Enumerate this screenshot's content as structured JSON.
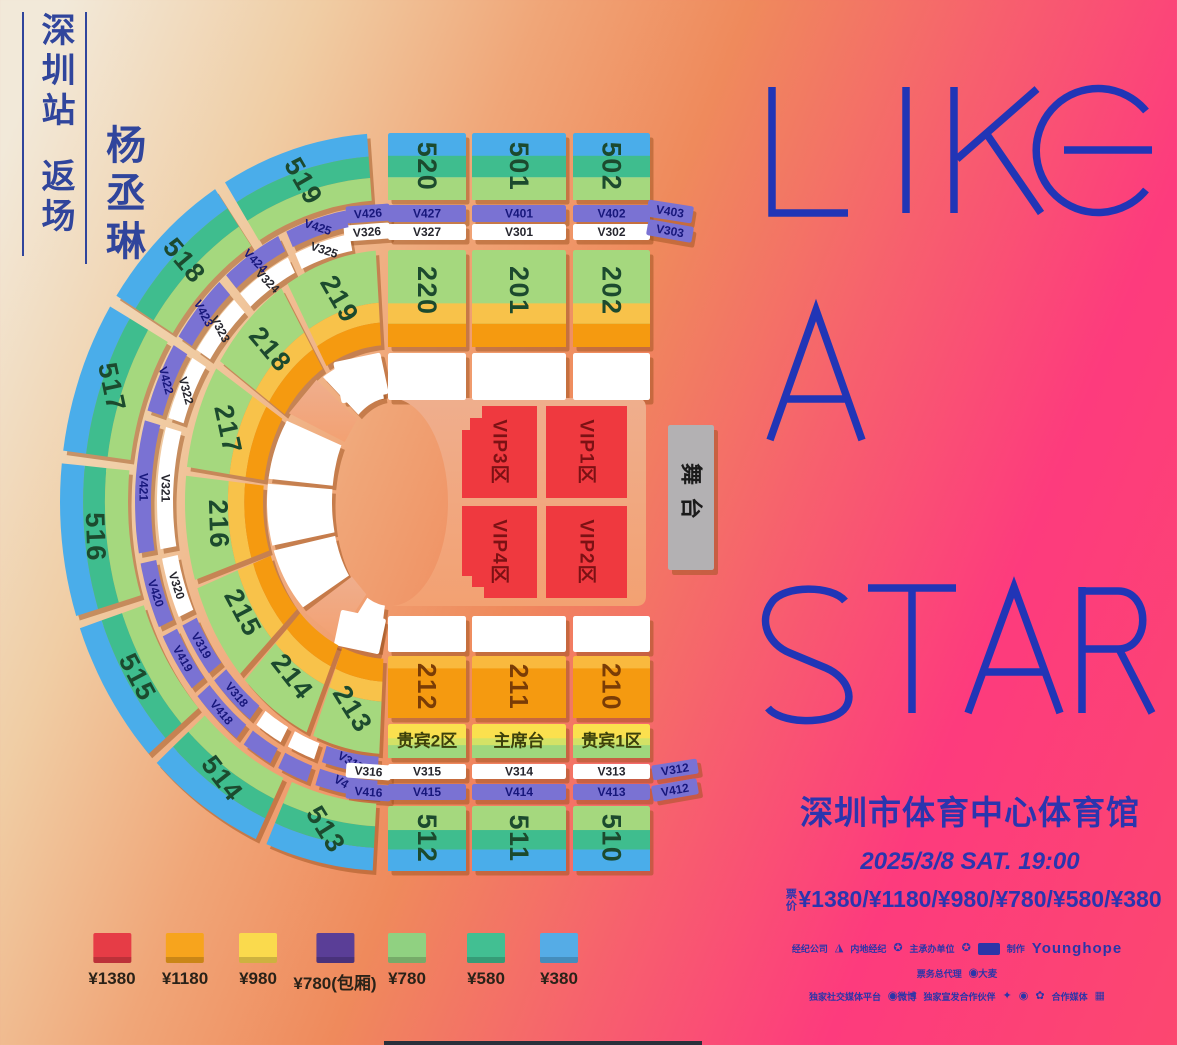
{
  "poster": {
    "header": {
      "station": "深圳站",
      "show_type": "返场",
      "artist": "杨丞琳"
    },
    "title_lines": [
      "LIKE",
      "A",
      "STAR"
    ],
    "title_color": "#2135b6",
    "venue": "深圳市体育中心体育馆",
    "datetime": "2025/3/8 SAT. 19:00",
    "price_label": "票价",
    "price_line": "¥1380/¥1180/¥980/¥780/¥580/¥380"
  },
  "map": {
    "stage_label": "舞台",
    "outer_top": [
      "520",
      "501",
      "502"
    ],
    "outer_arc": [
      "519",
      "518",
      "517",
      "516",
      "515",
      "514",
      "513"
    ],
    "outer_bottom": [
      "512",
      "511",
      "510"
    ],
    "inner_top": [
      "220",
      "201",
      "202"
    ],
    "inner_arc": [
      "219",
      "218",
      "217",
      "216",
      "215",
      "214",
      "213"
    ],
    "inner_bottom": [
      "212",
      "211",
      "210"
    ],
    "guest_boxes": [
      "贵宾2区",
      "主席台",
      "贵宾1区"
    ],
    "vip_zones": [
      "VIP3区",
      "VIP1区",
      "VIP4区",
      "VIP2区"
    ],
    "v_top_outer": [
      "V426",
      "V427",
      "V401",
      "V402",
      "V403"
    ],
    "v_top_inner": [
      "V326",
      "V327",
      "V301",
      "V302",
      "V303"
    ],
    "v_arc_pairs": [
      [
        "V425",
        "V325"
      ],
      [
        "V424",
        "V324"
      ],
      [
        "V423",
        "V323"
      ],
      [
        "V422",
        "V322"
      ],
      [
        "V421",
        "V321"
      ],
      [
        "V420",
        "V320"
      ],
      [
        "V419",
        "V319"
      ],
      [
        "V418",
        "V318"
      ],
      [
        "",
        ""
      ],
      [
        "",
        ""
      ],
      [
        "V417",
        "V317"
      ]
    ],
    "v_bottom_outer": [
      "V416",
      "V415",
      "V414",
      "V413",
      "V412"
    ],
    "v_bottom_inner": [
      "V316",
      "V315",
      "V314",
      "V313",
      "V312"
    ],
    "colors": {
      "blue": "#4aadea",
      "teal": "#3fbd8e",
      "light_green": "#a5d87e",
      "yellow_band": "#f8c24a",
      "orange": "#f59a10",
      "orange_light": "#f9b93e",
      "purple": "#7a72d3",
      "white": "#ffffff",
      "red": "#ef393f",
      "stage_gray": "#b3b1b3",
      "floor_top": "#efae8d",
      "floor_bottom": "#f3a172",
      "guest_yellow": "#fbe04e",
      "guest_mid": "#d3e266",
      "guest_green": "#9fd77d",
      "shadow": "rgba(156,82,30,0.5)",
      "label_green": "#1c4a2e",
      "label_brown": "#7a3c06",
      "label_navy": "#17177c",
      "label_dark": "#26262e",
      "guest_text": "#3c400b",
      "vip_text": "#7c1114",
      "stage_text": "#1b1b1b"
    }
  },
  "legend": {
    "items": [
      {
        "price": "¥1380",
        "color": "#e63c46"
      },
      {
        "price": "¥1180",
        "color": "#f7a41d"
      },
      {
        "price": "¥980",
        "color": "#fada4d"
      },
      {
        "price": "¥780(包厢)",
        "color": "#5a3e97"
      },
      {
        "price": "¥780",
        "color": "#90d181"
      },
      {
        "price": "¥580",
        "color": "#42bf92"
      },
      {
        "price": "¥380",
        "color": "#55ace6"
      }
    ]
  },
  "sponsors": {
    "row1": [
      {
        "type": "label",
        "text": "经纪公司"
      },
      {
        "type": "logo",
        "glyph": "◮"
      },
      {
        "type": "label",
        "text": "内地经纪"
      },
      {
        "type": "logo",
        "glyph": "✪"
      },
      {
        "type": "label",
        "text": "主承办单位"
      },
      {
        "type": "logo",
        "glyph": "✪"
      },
      {
        "type": "box"
      },
      {
        "type": "label",
        "text": "制作"
      },
      {
        "type": "brand",
        "text": "Younghope"
      }
    ],
    "row2": [
      {
        "type": "label",
        "text": "票务总代理"
      },
      {
        "type": "logotext",
        "text": "◉大麦"
      }
    ],
    "row3": [
      {
        "type": "label",
        "text": "独家社交媒体平台"
      },
      {
        "type": "logotext",
        "text": "◉微博"
      },
      {
        "type": "label",
        "text": "独家宣发合作伙伴"
      },
      {
        "type": "logo",
        "glyph": "✦"
      },
      {
        "type": "logo",
        "glyph": "◉"
      },
      {
        "type": "logo",
        "glyph": "✿"
      },
      {
        "type": "label",
        "text": "合作媒体"
      },
      {
        "type": "logo",
        "glyph": "▦"
      }
    ]
  }
}
